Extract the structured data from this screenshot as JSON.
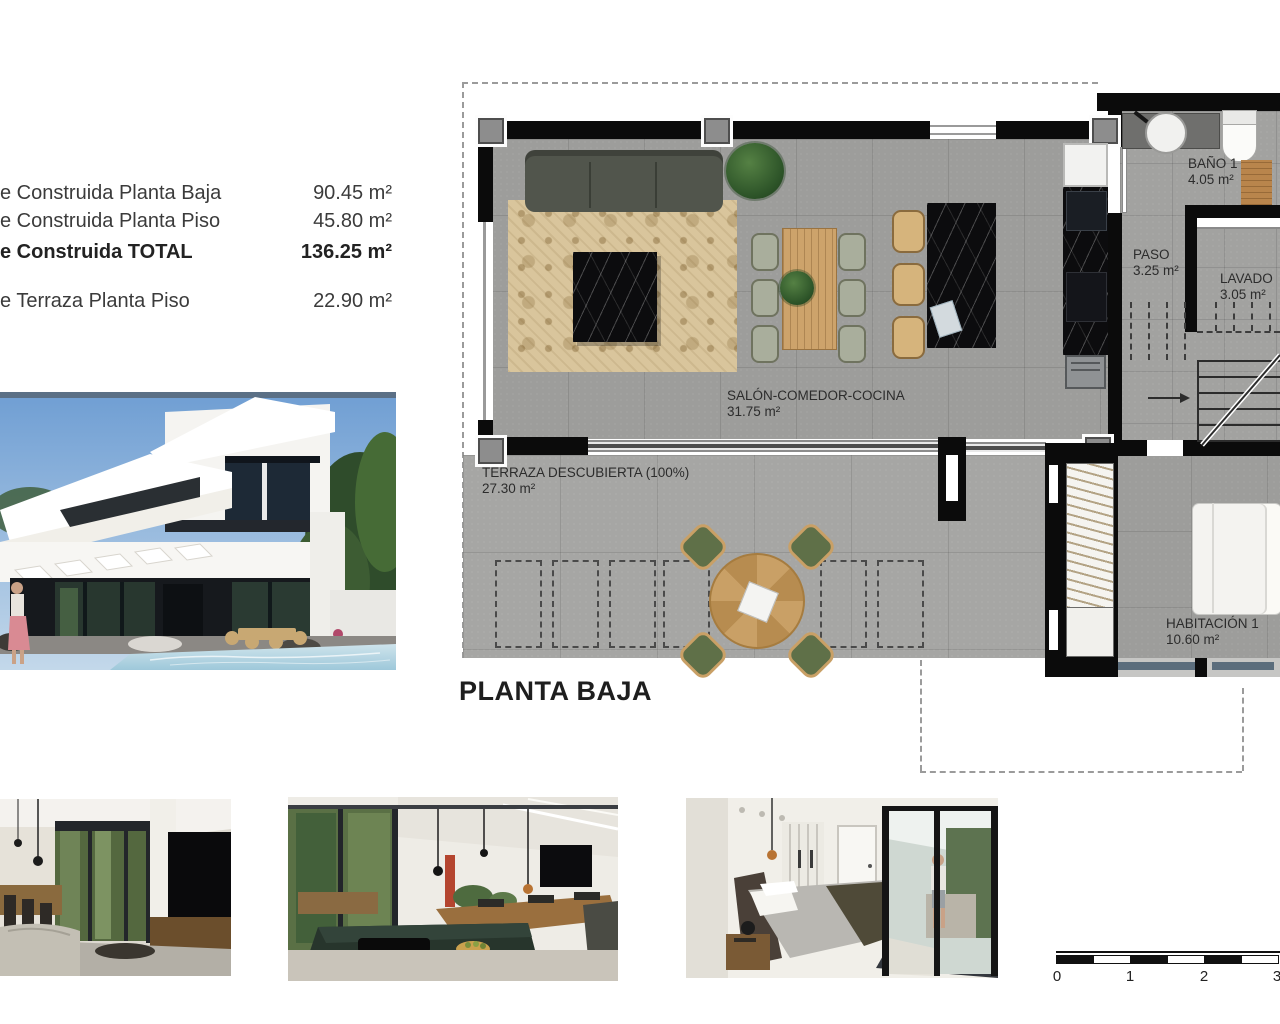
{
  "summary": {
    "rows": [
      {
        "label": "e Construida Planta Baja",
        "value": "90.45 m²"
      },
      {
        "label": "e Construida Planta Piso",
        "value": "45.80 m²"
      },
      {
        "label": "e Construida TOTAL",
        "value": "136.25 m²"
      },
      {
        "label": "e Terraza Planta Piso",
        "value": "22.90 m²"
      }
    ]
  },
  "floorplan": {
    "title": "PLANTA BAJA",
    "rooms": [
      {
        "name": "SALÓN-COMEDOR-COCINA",
        "area": "31.75 m²"
      },
      {
        "name": "TERRAZA DESCUBIERTA (100%)",
        "area": "27.30 m²"
      },
      {
        "name": "BAÑO 1",
        "area": "4.05 m²"
      },
      {
        "name": "PASO",
        "area": "3.25 m²"
      },
      {
        "name": "LAVADO",
        "area": "3.05 m²"
      },
      {
        "name": "HABITACIÓN 1",
        "area": "10.60 m²"
      }
    ]
  },
  "scalebar": {
    "labels": [
      "0",
      "1",
      "2",
      "3"
    ]
  },
  "colors": {
    "wall": "#0b0b0b",
    "floor_gray": "#9d9d9b",
    "terrace_gray": "#a6a6a4",
    "wood_accent": "#cda36b",
    "marble_black": "#0c0c0e",
    "glass_blue": "#5b6d7c"
  }
}
